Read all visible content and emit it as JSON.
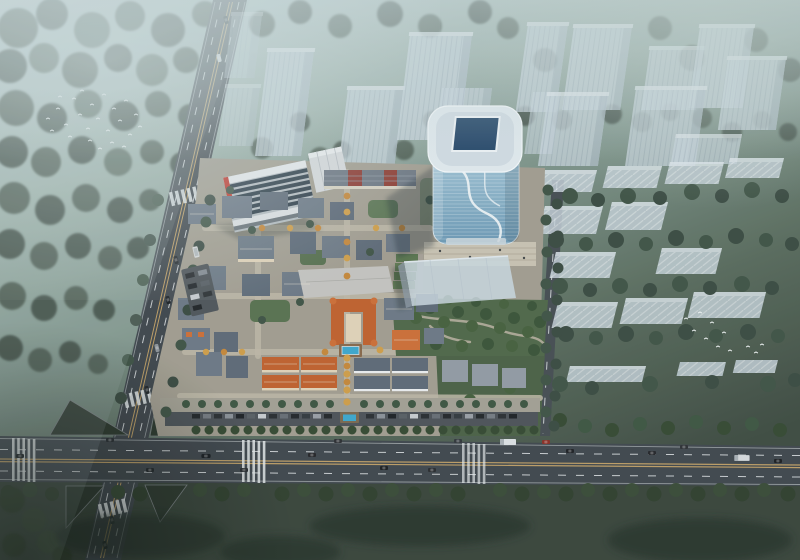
{
  "meta": {
    "type": "aerial architectural rendering",
    "subject": "Bird's-eye dusk view of a mixed-use development masterplan in morning haze"
  },
  "scene": {
    "site": "European-style low-rise quarter with gray mansard and terracotta roofs, chateau courtyard with swimming pool, autumn street trees",
    "tower": "Curved glass office high-rise with rounded white roof crown and rectangular skylight",
    "commercial": "Stepped-skylight retail block with red accent stripe and white annex",
    "future_hall": "Translucent massing block south-east of the tower beside a tree park",
    "context_north": "Semi-transparent placeholder residential towers among trees",
    "context_east": "Rows of translucent low slab housing with dense dark trees",
    "roads": "Tree-lined boulevard along the south with traffic, secondary road on the west, four-way intersection with grass islands and zebra crossings",
    "nature": "Misty forest in the north-west with flocks of white birds, lawns with long tree shadows in the south",
    "counts": {
      "context_towers": 15,
      "low_rise_slabs": 13,
      "moving_vehicles": 25,
      "parked_vehicles": 34,
      "birds": 35,
      "pools": 2
    }
  },
  "palette": {
    "fog_top": "#bfd0d3",
    "fog_mid": "#9fb4ac",
    "haze_green": "#7e948a",
    "dusk_green": "#5a6c5e",
    "ground_dark": "#3f4c42",
    "road_asphalt": "#41484e",
    "road_line_yellow": "#c0a068",
    "road_line_white": "#e4e8ea",
    "lawn": "#3a463c",
    "grass_island": "#2e3a30",
    "ghost_glass": "#cdd9e2",
    "tower_glass_top": "#a7c9da",
    "tower_glass_bottom": "#6e9bb7",
    "tower_roof": "#e3ebf0",
    "tower_skylight": "#26486a",
    "tower_ribbon": "#f4f8fa",
    "accent_red": "#c23a2e",
    "facade_red": "#8f3c33",
    "roof_orange": "#c2622f",
    "roof_gray": "#6e7a87",
    "pool_water": "#3fa9cf",
    "pool_deck": "#8a6a4c",
    "park_green": "#51694a",
    "site_ground": "#a49f92",
    "plaza_paving": "#cbc5b5",
    "bird_white": "#f3f7f7",
    "car_white": "#dde1e4",
    "car_red": "#8c3026"
  }
}
